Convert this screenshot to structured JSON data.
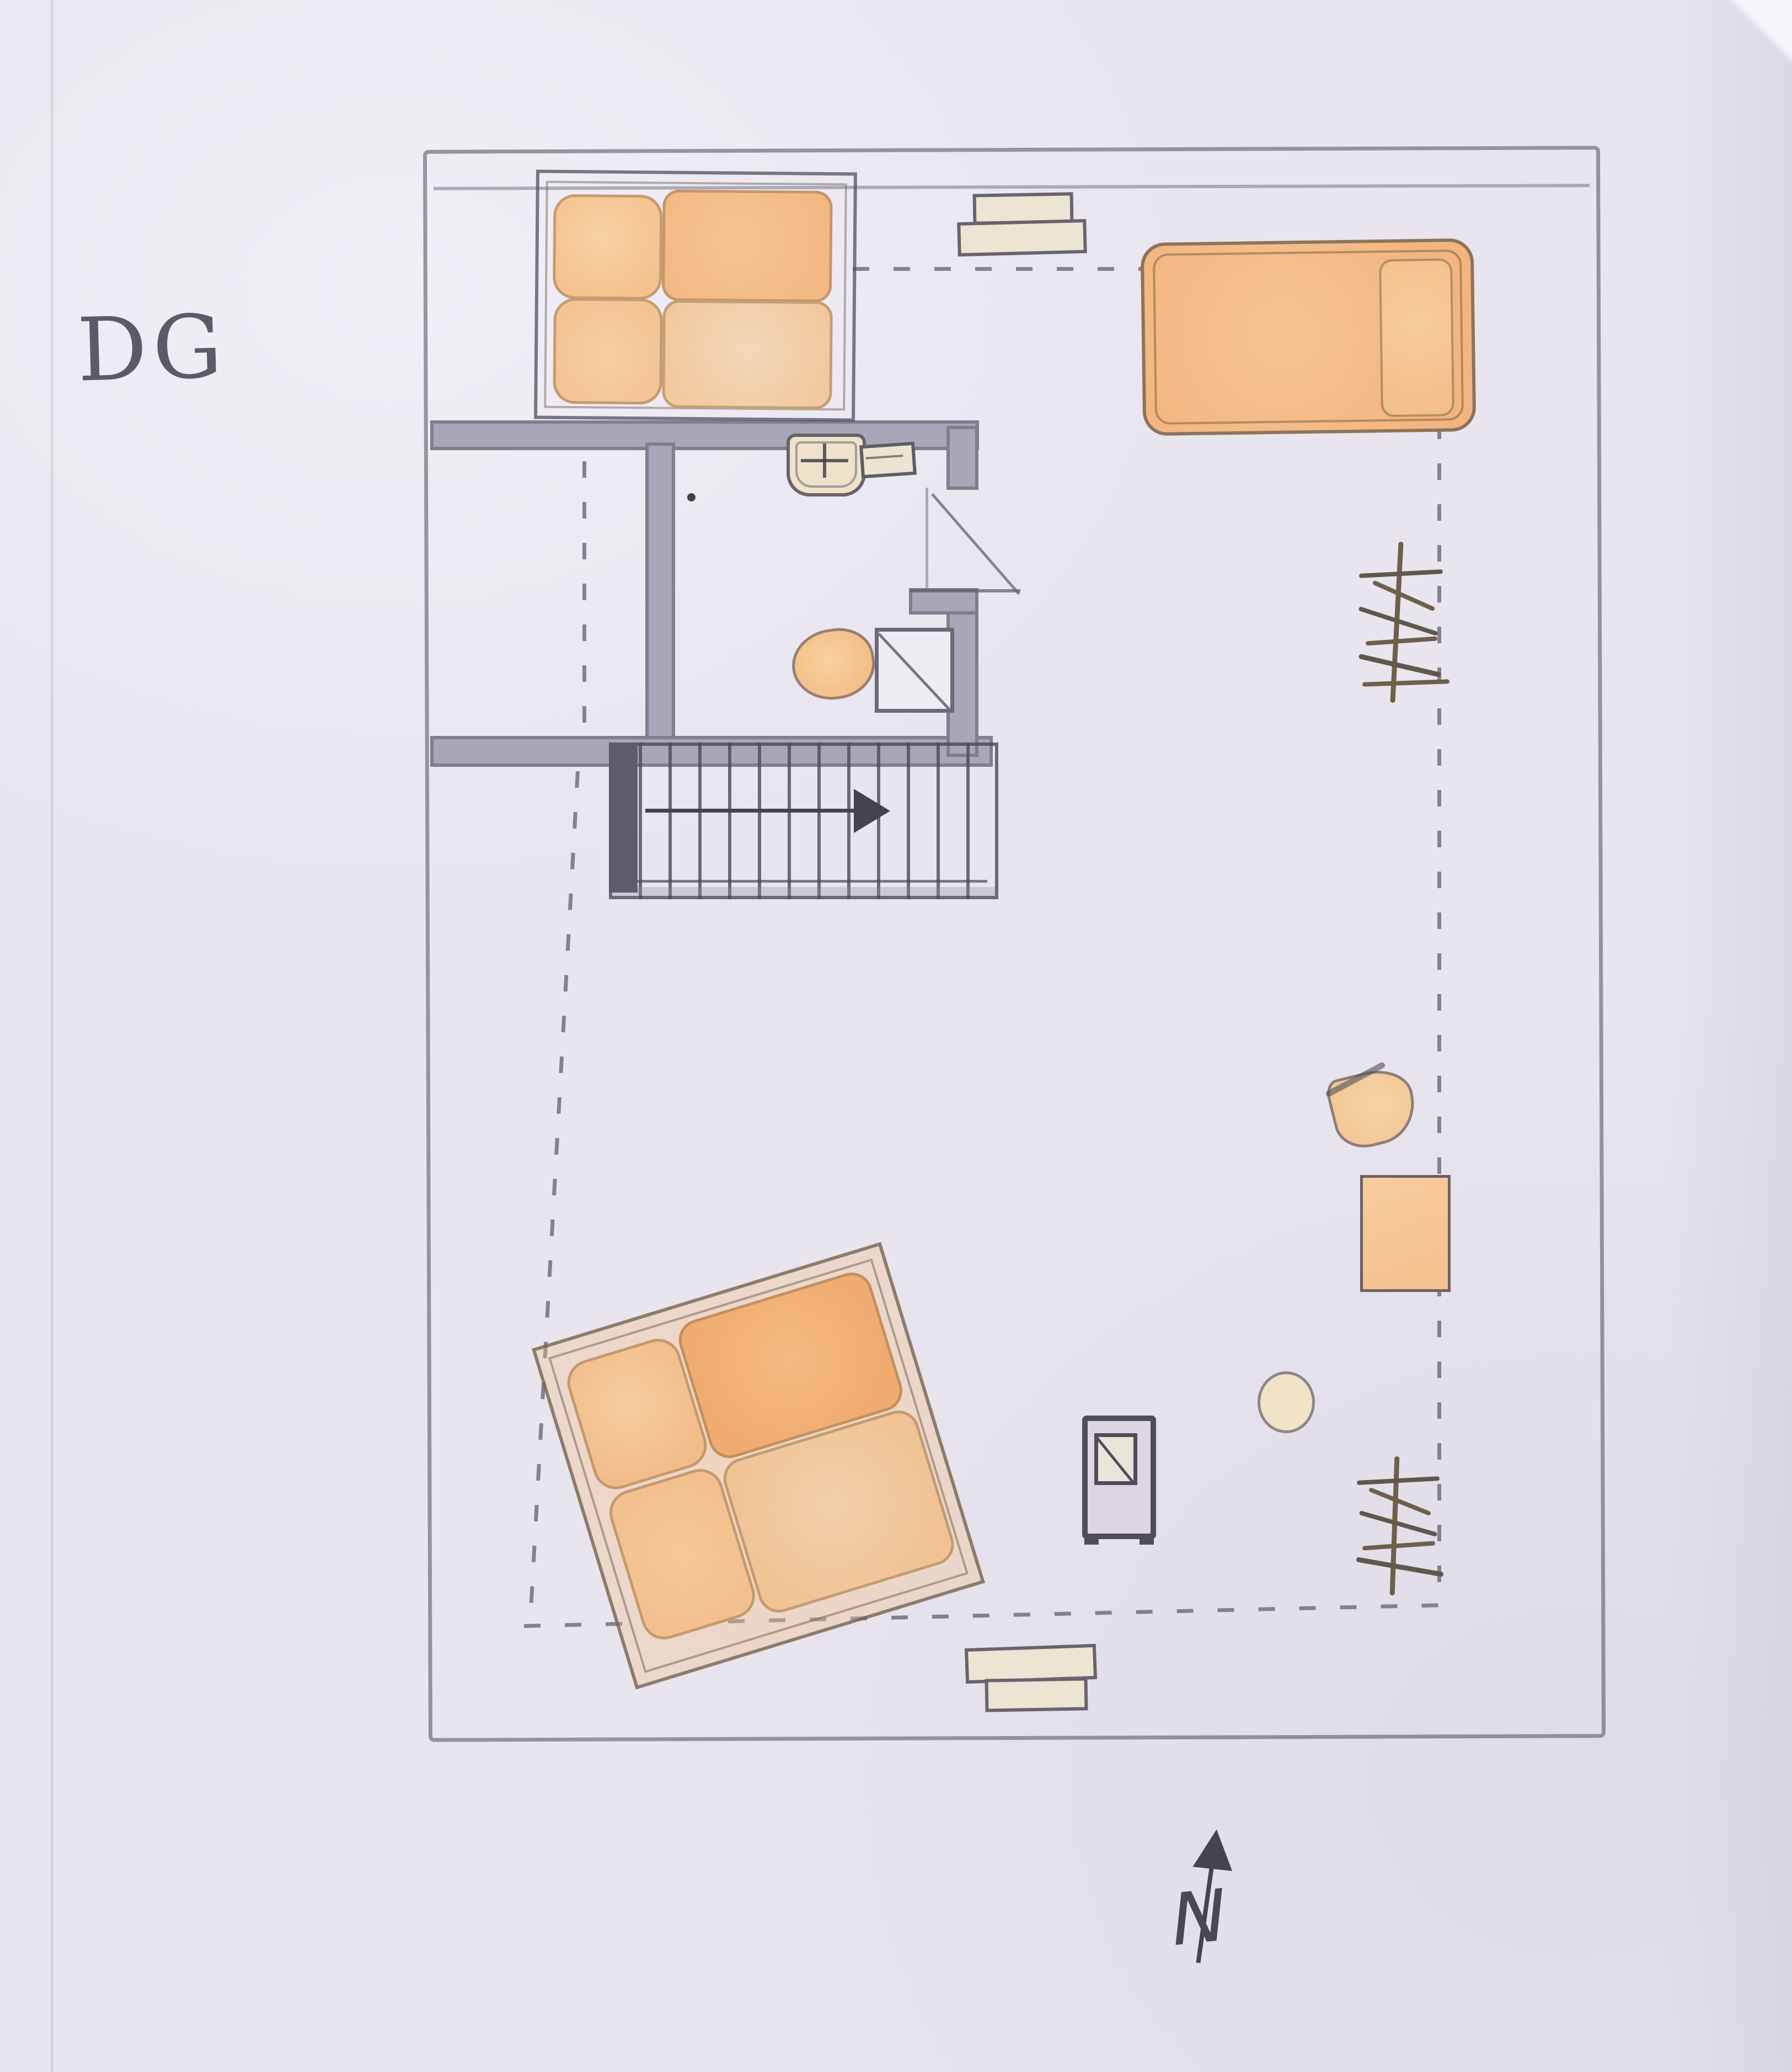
{
  "meta": {
    "kind": "hand-drawn attic floor plan, pencil and orange watercolor on paper",
    "floor_label": "DG",
    "compass_letter": "N"
  },
  "palette": {
    "paper": "#e9e5ef",
    "pencil": "#5f5c6c",
    "pencil_dark": "#45434f",
    "wall_fill": "#a9a6b7",
    "watercolor_orange": "#f4bc88",
    "watercolor_orange_deep": "#f2b078",
    "watercolor_orange_light": "#f1d2ad",
    "watercolor_cream": "#efe3cc",
    "plant_brown": "#6e6049",
    "dash_gray": "#8a879b"
  },
  "plan": {
    "rooms": [
      {
        "name": "bedroom-top-left"
      },
      {
        "name": "closet-with-roof-slope"
      },
      {
        "name": "bathroom"
      },
      {
        "name": "open-attic-room"
      }
    ],
    "furniture": [
      {
        "name": "double-bed-top-left",
        "parts": [
          "pillow",
          "pillow",
          "mattress",
          "mattress"
        ]
      },
      {
        "name": "single-bed-top-right",
        "parts": [
          "mattress",
          "pillow"
        ]
      },
      {
        "name": "double-bed-rotated",
        "rotation_deg": -17,
        "parts": [
          "pillow",
          "pillow",
          "mattress",
          "mattress"
        ]
      },
      {
        "name": "wall-shelf-top",
        "count": 2
      },
      {
        "name": "wall-shelf-bottom",
        "count": 2
      },
      {
        "name": "sink-with-faucet-cross"
      },
      {
        "name": "soap-dish"
      },
      {
        "name": "toilet"
      },
      {
        "name": "shower-with-diagonal"
      },
      {
        "name": "staircase",
        "steps": 13,
        "arrow_direction": "right"
      },
      {
        "name": "armchair"
      },
      {
        "name": "table"
      },
      {
        "name": "stool"
      },
      {
        "name": "stove"
      },
      {
        "name": "plant-upper"
      },
      {
        "name": "plant-lower"
      },
      {
        "name": "north-arrow"
      }
    ],
    "dashed_lines_meaning": "roof knee-wall height lines drawn dashed around the open attic space"
  }
}
